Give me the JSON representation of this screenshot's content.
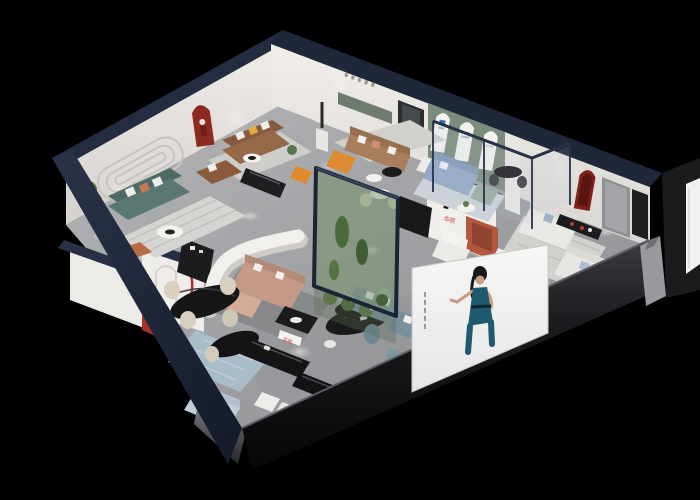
{
  "brand": {
    "logo_letter": "H",
    "wall_sign_text": "华凯",
    "storefront_sign_text": "华凯",
    "logo_red": "#c0392b",
    "logo_black": "#1b1b1b"
  },
  "palette": {
    "background": "#000000",
    "wall_top_navy": "#232c40",
    "wall_face": "#ece9e5",
    "floor_gray": "#a7a9ab",
    "facade_navy": "#273046",
    "sage_wall": "#7c8b7b",
    "accent_red": "#a93227",
    "accent_rust": "#b4573f",
    "accent_orange": "#de8b31",
    "sofa_teal": "#5a7872",
    "sofa_brown": "#96684a",
    "sofa_tan": "#a87e5f",
    "sofa_blush": "#c49a86",
    "sofa_blue": "#93a9c6",
    "sofa_white": "#e9e8e4",
    "glass_green": "#6d8a5e",
    "poster_bg": "#f5f4f2",
    "poster_dress": "#1d5a6e"
  }
}
